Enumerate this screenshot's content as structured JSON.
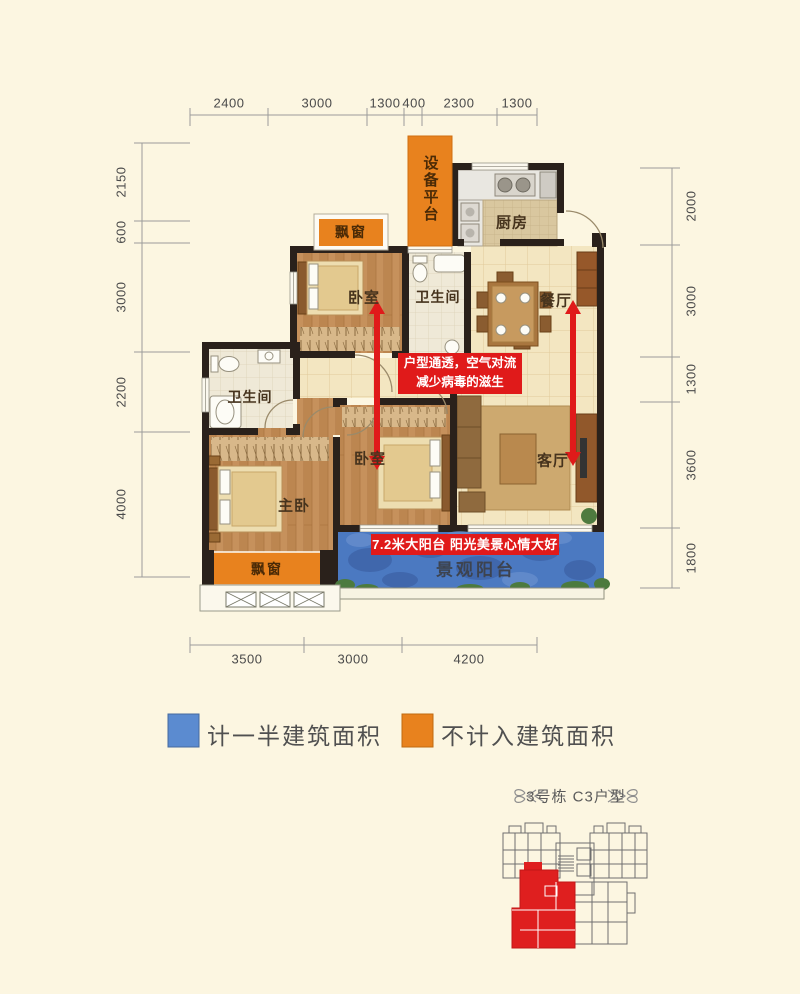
{
  "plan": {
    "rooms": {
      "equipment_platform": "设备平台",
      "kitchen": "厨房",
      "dining": "餐厅",
      "bedroom_top": "卧室",
      "bathroom_top": "卫生间",
      "bathroom_left": "卫生间",
      "master_bedroom": "主卧",
      "bedroom_middle": "卧室",
      "living": "客厅",
      "balcony": "景观阳台",
      "bay_window_top": "飘窗",
      "bay_window_bottom": "飘窗"
    },
    "annotations": {
      "airflow_line1": "户型通透，空气对流",
      "airflow_line2": "减少病毒的滋生",
      "balcony_banner": "7.2米大阳台 阳光美景心情大好"
    }
  },
  "dimensions": {
    "top": [
      "2400",
      "3000",
      "1300",
      "400",
      "2300",
      "1300"
    ],
    "left": [
      "2150",
      "600",
      "3000",
      "2200",
      "4000"
    ],
    "right": [
      "2000",
      "3000",
      "1300",
      "3600",
      "1800"
    ],
    "bottom": [
      "3500",
      "3000",
      "4200"
    ]
  },
  "legend": {
    "items": [
      {
        "label": "计一半建筑面积",
        "color": "#5B8BD0"
      },
      {
        "label": "不计入建筑面积",
        "color": "#E8821E"
      }
    ]
  },
  "footer": {
    "unit_title": "3号栋 C3户型"
  },
  "colors": {
    "accent_orange": "#E8821E",
    "legend_blue": "#5B8BD0",
    "annotation_red": "#E01A1A",
    "balcony_blue": "#4B79C1",
    "wall_dark": "#2A211B"
  }
}
